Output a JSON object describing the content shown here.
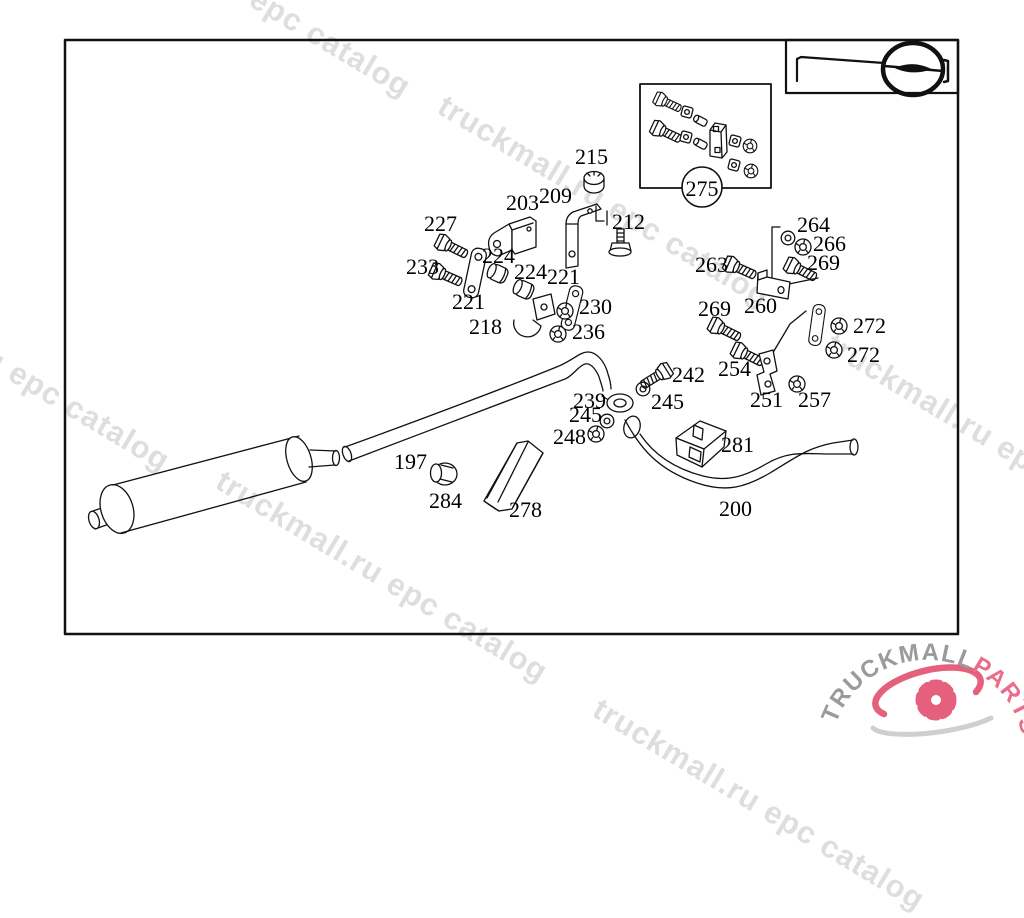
{
  "watermark": {
    "text": "truckmall.ru epc catalog",
    "color": "#dedede"
  },
  "callout": {
    "text": "275"
  },
  "labels": [
    "215",
    "203",
    "209",
    "212",
    "227",
    "233",
    "224",
    "224",
    "221",
    "221",
    "218",
    "230",
    "236",
    "264",
    "266",
    "263",
    "269",
    "269",
    "260",
    "272",
    "272",
    "254",
    "251",
    "257",
    "242",
    "245",
    "239",
    "245",
    "248",
    "281",
    "197",
    "284",
    "278",
    "200"
  ],
  "logo": {
    "text_gray": "TRUCKMALL",
    "text_pink": "PARTS",
    "gray_color": "#9a9a9a",
    "pink_color": "#ec6d89",
    "gear_color": "#e4607d"
  },
  "line_color": "#111111"
}
